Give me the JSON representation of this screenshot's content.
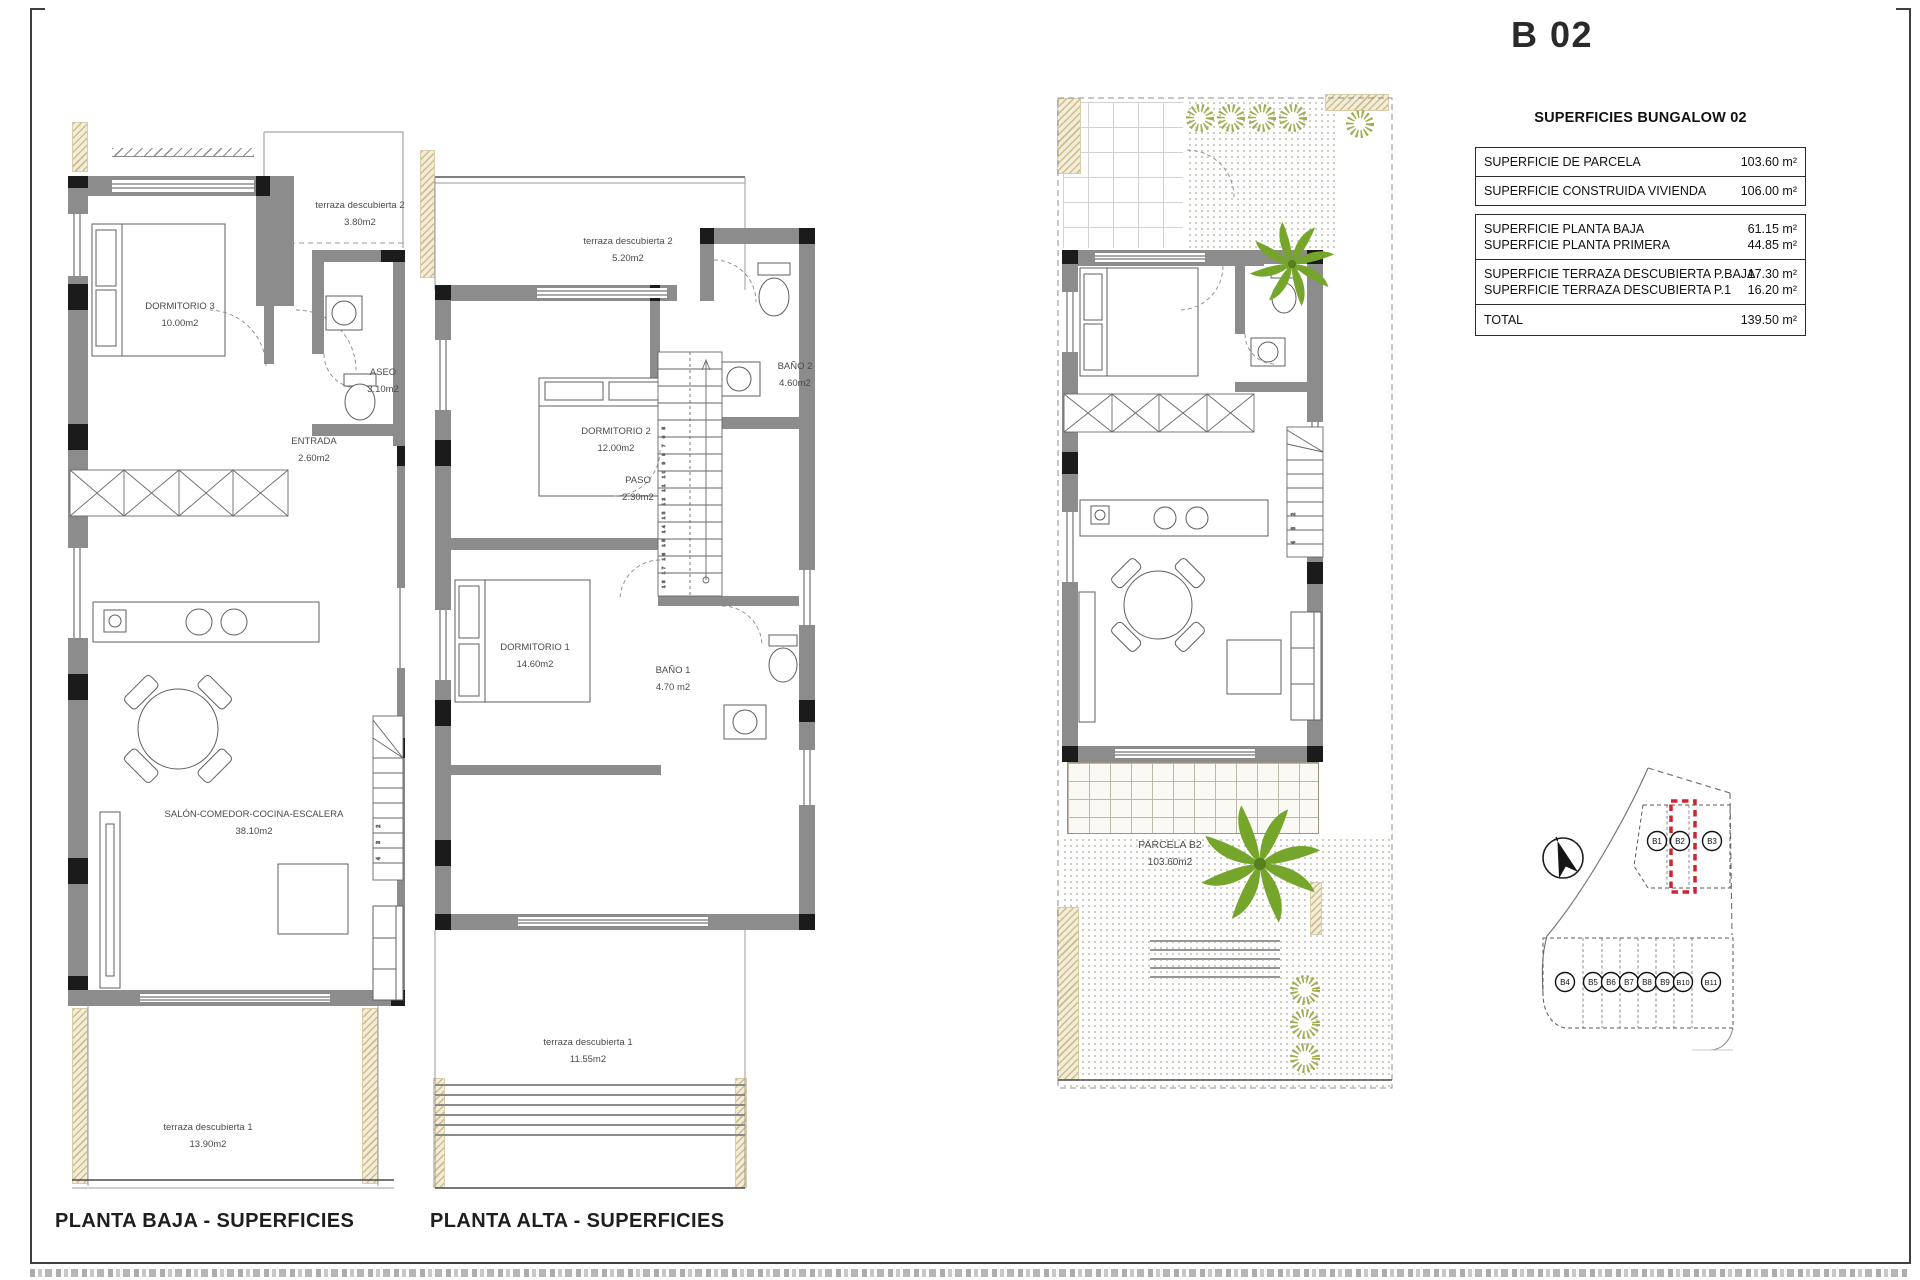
{
  "sheet": {
    "title": "B 02"
  },
  "table": {
    "heading": "SUPERFICIES BUNGALOW 02",
    "rows": [
      {
        "label": "SUPERFICIE DE PARCELA",
        "value": "103.60 m²"
      },
      {
        "label": "SUPERFICIE CONSTRUIDA VIVIENDA",
        "value": "106.00 m²"
      },
      {
        "label": "SUPERFICIE PLANTA BAJA",
        "value": "61.15 m²"
      },
      {
        "label": "SUPERFICIE PLANTA PRIMERA",
        "value": "44.85 m²"
      },
      {
        "label": "SUPERFICIE TERRAZA DESCUBIERTA P.BAJA",
        "value": "17.30 m²"
      },
      {
        "label": "SUPERFICIE TERRAZA DESCUBIERTA P.1",
        "value": "16.20 m²"
      },
      {
        "label": "TOTAL",
        "value": "139.50 m²"
      }
    ]
  },
  "plans": {
    "baja": {
      "caption": "PLANTA BAJA - SUPERFICIES",
      "stair_numbers": "4 3 2",
      "rooms": {
        "terraza2": {
          "name": "terraza descubierta 2",
          "area": "3.80m2"
        },
        "dormitorio3": {
          "name": "DORMITORIO 3",
          "area": "10.00m2"
        },
        "aseo": {
          "name": "ASEO",
          "area": "3.10m2"
        },
        "entrada": {
          "name": "ENTRADA",
          "area": "2.60m2"
        },
        "salon": {
          "name": "SALÓN-COMEDOR-COCINA-ESCALERA",
          "area": "38.10m2"
        },
        "terraza1": {
          "name": "terraza descubierta 1",
          "area": "13.90m2"
        }
      }
    },
    "alta": {
      "caption": "PLANTA ALTA - SUPERFICIES",
      "stair_numbers": "18 17 16 15 14 13 12 11 10 9 8 7 6 5",
      "rooms": {
        "terraza2": {
          "name": "terraza descubierta 2",
          "area": "5.20m2"
        },
        "dormitorio2": {
          "name": "DORMITORIO 2",
          "area": "12.00m2"
        },
        "bano2": {
          "name": "BAÑO 2",
          "area": "4.60m2"
        },
        "paso": {
          "name": "PASO",
          "area": "2.30m2"
        },
        "dormitorio1": {
          "name": "DORMITORIO 1",
          "area": "14.60m2"
        },
        "bano1": {
          "name": "BAÑO 1",
          "area": "4.70 m2"
        },
        "terraza1": {
          "name": "terraza descubierta 1",
          "area": "11.55m2"
        }
      }
    },
    "parcela": {
      "stair_numbers": "4 3 2",
      "label": {
        "name": "PARCELA B2",
        "area": "103.60m2"
      }
    }
  },
  "siteplan": {
    "highlighted_unit": "B2",
    "highlight_color": "#d02430",
    "units_top": [
      {
        "id": "B1"
      },
      {
        "id": "B2"
      },
      {
        "id": "B3"
      }
    ],
    "units_bottom": [
      {
        "id": "B4"
      },
      {
        "id": "B5"
      },
      {
        "id": "B6"
      },
      {
        "id": "B7"
      },
      {
        "id": "B8"
      },
      {
        "id": "B9"
      },
      {
        "id": "B10"
      },
      {
        "id": "B11"
      }
    ]
  }
}
